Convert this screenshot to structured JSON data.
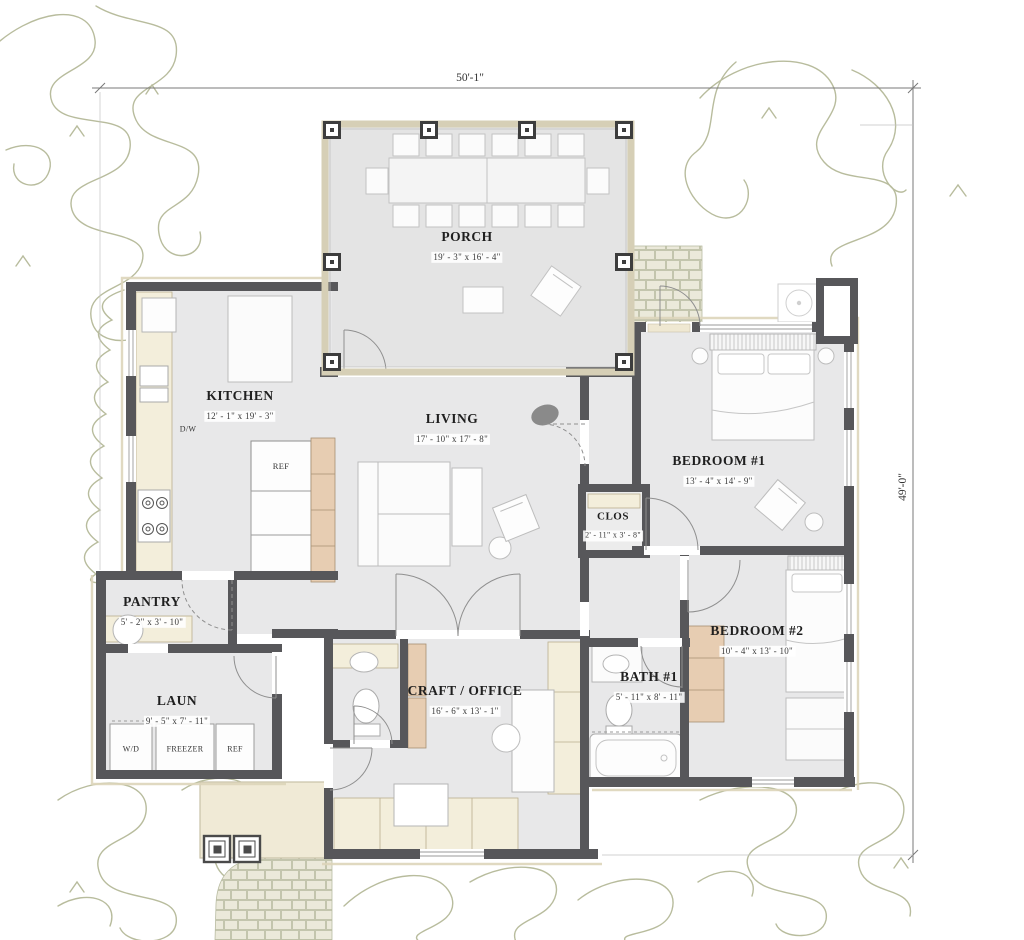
{
  "title": "Floor Plan",
  "dimensions": {
    "width_label": "50'-1\"",
    "height_label": "49'-0\""
  },
  "rooms": {
    "porch": {
      "name": "PORCH",
      "size": "19' - 3\" x 16' - 4\""
    },
    "kitchen": {
      "name": "KITCHEN",
      "size": "12' - 1\" x 19' - 3\""
    },
    "living": {
      "name": "LIVING",
      "size": "17' - 10\" x 17' - 8\""
    },
    "bedroom1": {
      "name": "BEDROOM #1",
      "size": "13' - 4\" x 14' - 9\""
    },
    "closet": {
      "name": "CLOS",
      "size": "2' - 11\" x 3' - 8\""
    },
    "bedroom2": {
      "name": "BEDROOM #2",
      "size": "10' - 4\" x 13' - 10\""
    },
    "bath1": {
      "name": "BATH #1",
      "size": "5' - 11\" x 8' - 11\""
    },
    "pantry": {
      "name": "PANTRY",
      "size": "5' - 2\" x 3' - 10\""
    },
    "laundry": {
      "name": "LAUN",
      "size": "9' - 5\" x 7' - 11\""
    },
    "craft_office": {
      "name": "CRAFT / OFFICE",
      "size": "16' - 6\" x 13' - 1\""
    }
  },
  "labels": {
    "dishwasher": "D/W",
    "ref_kitchen": "REF",
    "washer_dryer": "W/D",
    "freezer": "FREEZER",
    "ref_laundry": "REF"
  },
  "colors": {
    "wall": "#57575a",
    "floor": "#e8e8e9",
    "casework_cream": "#f3eedb",
    "casework_tan": "#e7cdb2",
    "stone": "#ebe9da",
    "landscape": "#b8bc9d"
  }
}
